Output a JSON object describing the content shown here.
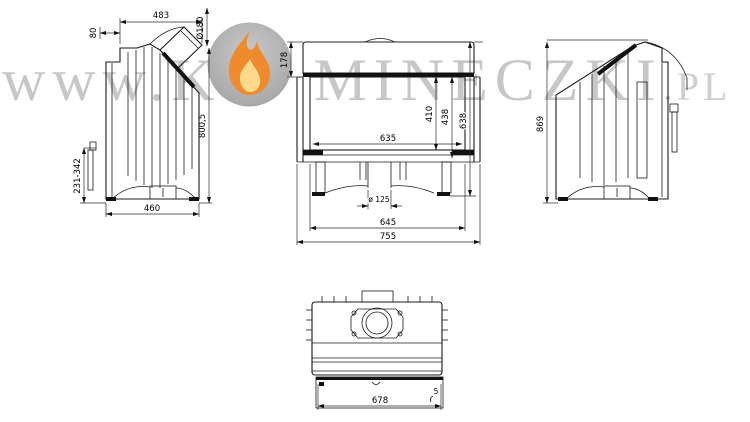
{
  "watermark": {
    "prefix": "www.K",
    "middle": "MINECZKI",
    "tld": ".PL"
  },
  "logo": {
    "icon": "flame-logo-icon"
  },
  "colors": {
    "line": "#1b1b1b",
    "watermark_gray": "#c7c7c7",
    "logo_circle_gray": "#b2b2b2",
    "flame_orange": "#ef8b2d",
    "flame_yellow": "#fcd98b",
    "background": "#ffffff"
  },
  "drawing_labels": {
    "left_view": {
      "top_width": "483",
      "flue_diameter": "Ø180",
      "top_offset": "80",
      "total_height": "800,5",
      "leg_height_range": "231-342",
      "depth": "460"
    },
    "front_view": {
      "hood_height": "178",
      "glass_width": "635",
      "opening_height": "410",
      "door_height": "438",
      "front_height": "638",
      "air_inlet_diameter": "ø 125",
      "inner_width": "645",
      "total_width": "755"
    },
    "right_view": {
      "total_height": "869"
    },
    "top_view": {
      "body_width": "678",
      "wall_thickness": "5"
    }
  }
}
